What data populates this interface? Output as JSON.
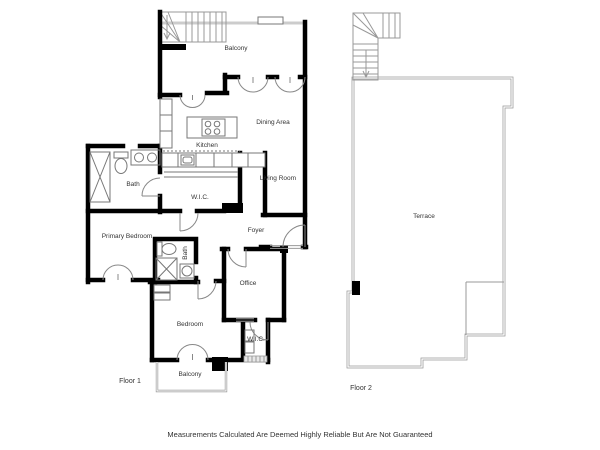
{
  "disclaimer": "Measurements Calculated Are Deemed Highly Reliable But Are Not Guaranteed",
  "floor1": {
    "label": "Floor 1",
    "rooms": {
      "balcony_top": "Balcony",
      "dining": "Dining Area",
      "kitchen": "Kitchen",
      "living": "Living Room",
      "bath1": "Bath",
      "wic1": "W.I.C.",
      "primary_bedroom": "Primary Bedroom",
      "foyer": "Foyer",
      "bath2": "Bath",
      "office": "Office",
      "bedroom": "Bedroom",
      "wic2": "W.I.C.",
      "balcony_bottom": "Balcony"
    }
  },
  "floor2": {
    "label": "Floor 2",
    "rooms": {
      "terrace": "Terrace"
    }
  },
  "colors": {
    "wall": "#000000",
    "fixture_line": "#777777",
    "terrace_outline": "#999999",
    "background": "#ffffff",
    "text": "#333333"
  }
}
